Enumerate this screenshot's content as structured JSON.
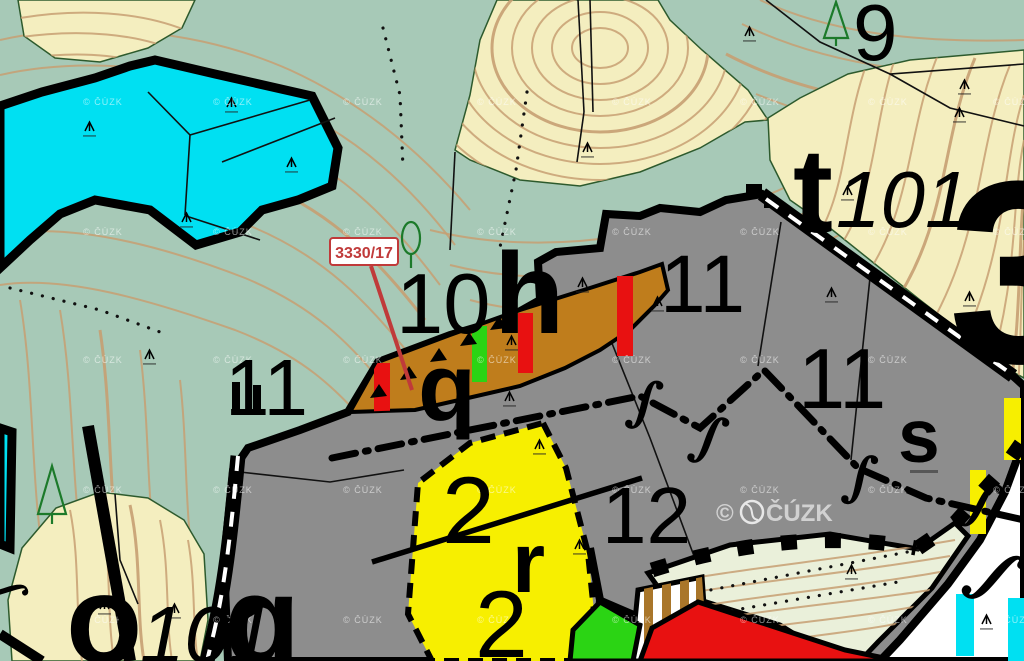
{
  "map": {
    "attribution": {
      "small": "© ČÚZK",
      "large": "ČÚZK",
      "copyright_sign": "©"
    },
    "highlight": {
      "label": "3330/17"
    },
    "symbols": {
      "boundary_glyph": "∫"
    },
    "labels": [
      {
        "id": "use-9",
        "text": "9"
      },
      {
        "id": "use-t",
        "text": "t"
      },
      {
        "id": "use-t101",
        "text": "101"
      },
      {
        "id": "use-3",
        "text": "3"
      },
      {
        "id": "use-10",
        "text": "10"
      },
      {
        "id": "use-h",
        "text": "h"
      },
      {
        "id": "use-11a",
        "text": "11"
      },
      {
        "id": "use-11b",
        "text": "11"
      },
      {
        "id": "use-11c",
        "text": "11"
      },
      {
        "id": "use-q1",
        "text": "q"
      },
      {
        "id": "use-2a",
        "text": "2"
      },
      {
        "id": "use-r",
        "text": "r"
      },
      {
        "id": "use-2b",
        "text": "2"
      },
      {
        "id": "use-12",
        "text": "12"
      },
      {
        "id": "use-s",
        "text": "s"
      },
      {
        "id": "use-o",
        "text": "o"
      },
      {
        "id": "use-o101",
        "text": "101"
      },
      {
        "id": "use-q2",
        "text": "q"
      }
    ],
    "colors": {
      "teal": "#a7c9b7",
      "cream": "#f4eebf",
      "contour": "#c79f72",
      "cyan": "#00e0f2",
      "gray": "#8d8d8d",
      "ochre": "#bf7d1c",
      "yellow": "#f7ef00",
      "parcel-red": "#e81111",
      "parcel-green": "#2bd414",
      "meadow": "#eaf0da",
      "stripe-brown": "#a9762a",
      "forest-line": "#2d5a2d",
      "white": "#ffffff",
      "highlight-red": "#c03a3a"
    }
  }
}
